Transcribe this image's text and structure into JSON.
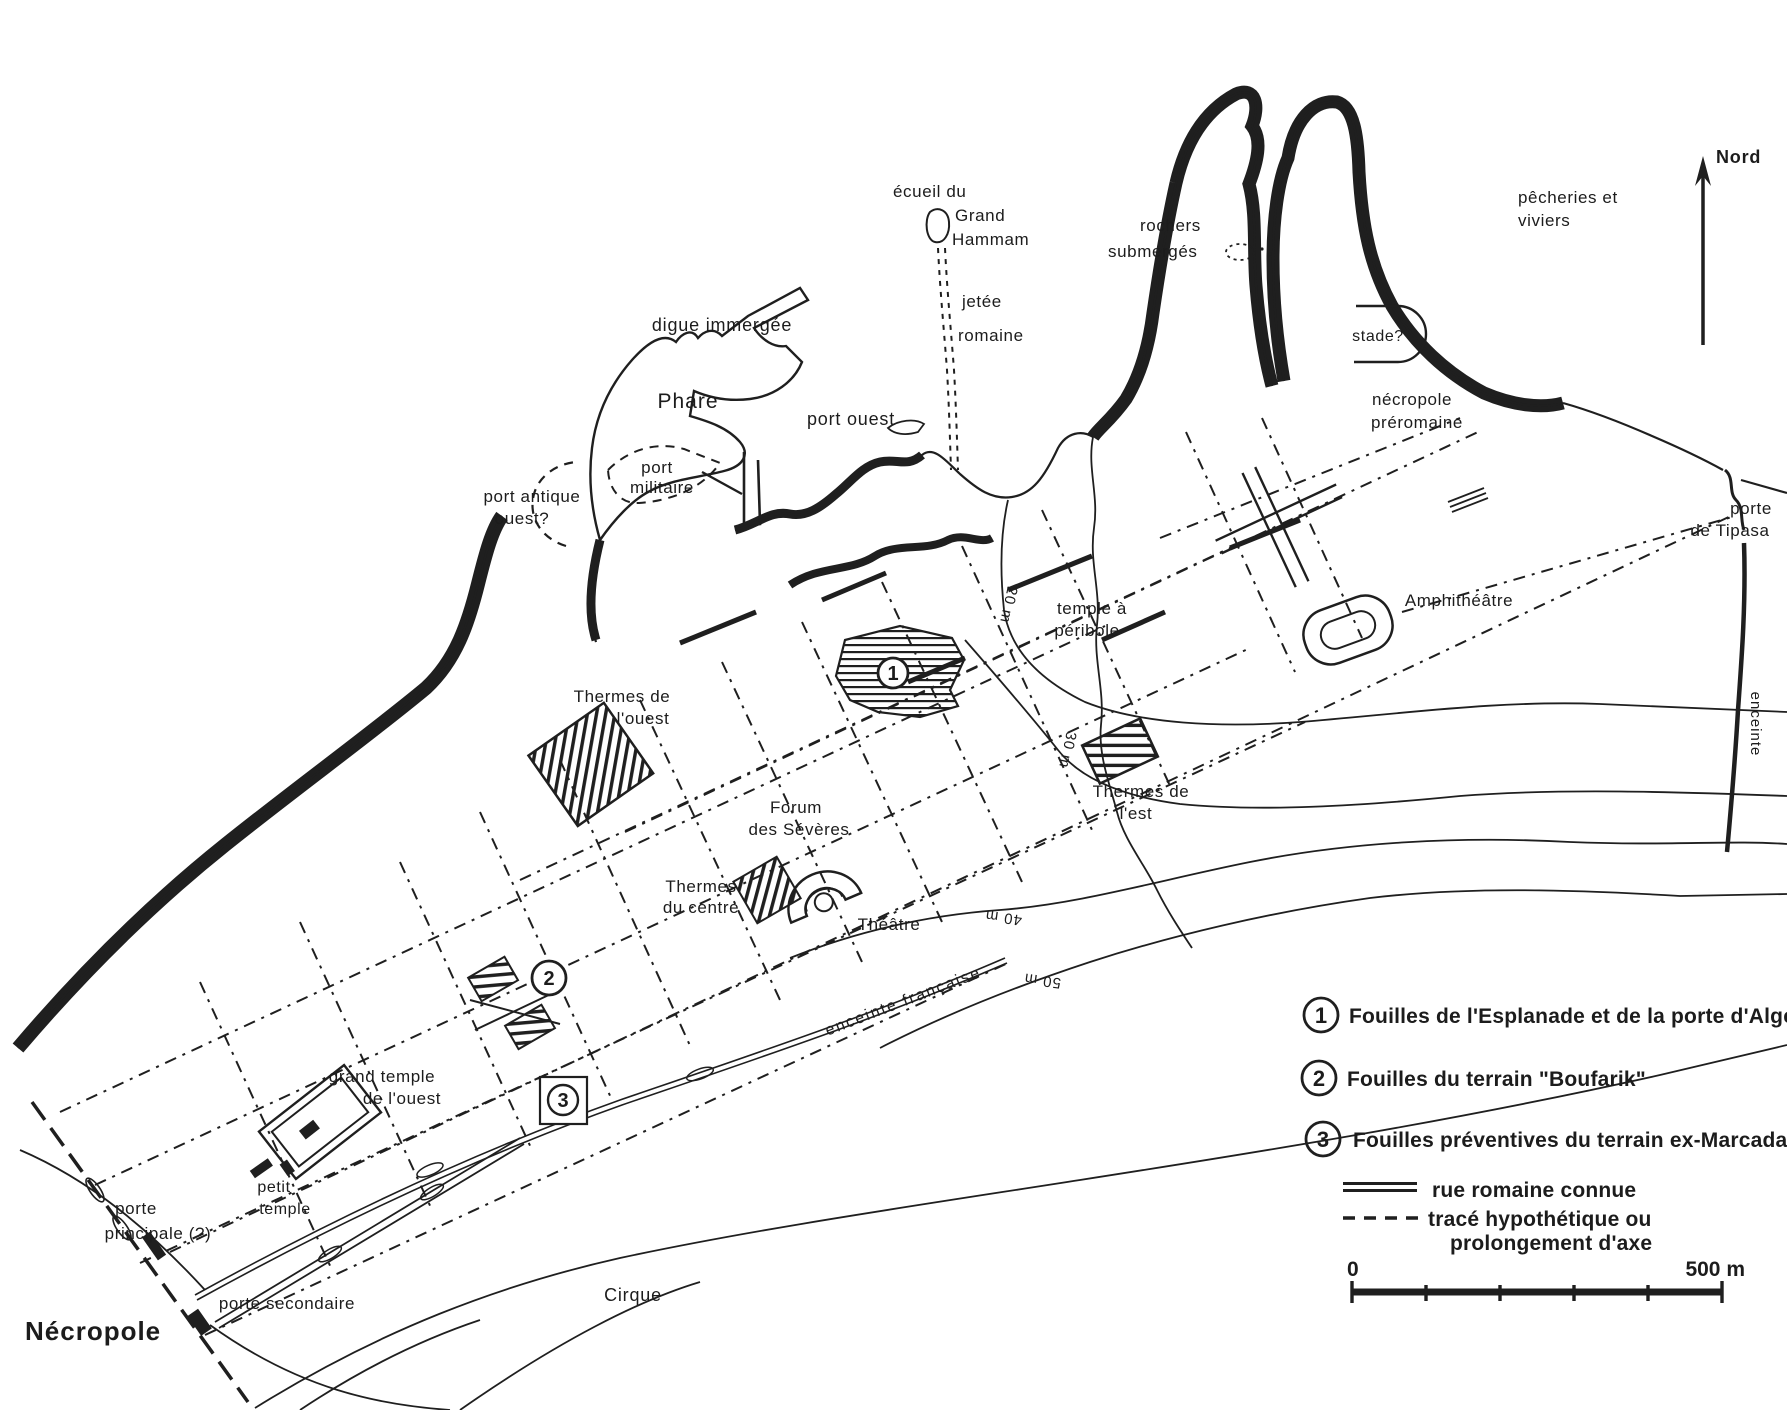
{
  "colors": {
    "ink": "#1f1f1f",
    "paper": "#ffffff"
  },
  "north": {
    "label": "Nord"
  },
  "map": {
    "labels": [
      {
        "text": "Nord"
      },
      {
        "text": "pêcheries et"
      },
      {
        "text": "viviers"
      },
      {
        "text": "écueil du"
      },
      {
        "text": "Grand"
      },
      {
        "text": "Hammam"
      },
      {
        "text": "jetée"
      },
      {
        "text": "romaine"
      },
      {
        "text": "rochers"
      },
      {
        "text": "submergés"
      },
      {
        "text": "digue immergée"
      },
      {
        "text": "Phare"
      },
      {
        "text": "port ouest"
      },
      {
        "text": "port"
      },
      {
        "text": "militaire"
      },
      {
        "text": "port antique"
      },
      {
        "text": "ouest?"
      },
      {
        "text": "stade?"
      },
      {
        "text": "nécropole"
      },
      {
        "text": "préromaine"
      },
      {
        "text": "porte"
      },
      {
        "text": "de Tipasa"
      },
      {
        "text": "Amphithéâtre"
      },
      {
        "text": "temple à"
      },
      {
        "text": "péribole"
      },
      {
        "text": "Thermes de"
      },
      {
        "text": "l'ouest"
      },
      {
        "text": "Forum"
      },
      {
        "text": "des Sévères"
      },
      {
        "text": "Thermes"
      },
      {
        "text": "du centre"
      },
      {
        "text": "Théâtre"
      },
      {
        "text": "Thermes de"
      },
      {
        "text": "l'est"
      },
      {
        "text": "grand temple"
      },
      {
        "text": "de l'ouest"
      },
      {
        "text": "petit"
      },
      {
        "text": "temple"
      },
      {
        "text": "porte"
      },
      {
        "text": "principale (?)"
      },
      {
        "text": "porte secondaire"
      },
      {
        "text": "Nécropole"
      },
      {
        "text": "Cirque"
      },
      {
        "text": "enceinte française"
      },
      {
        "text": "enceinte"
      },
      {
        "text": "20 m"
      },
      {
        "text": "30 m"
      },
      {
        "text": "40 m"
      },
      {
        "text": "50 m"
      }
    ],
    "markers": [
      {
        "num": "1"
      },
      {
        "num": "2"
      },
      {
        "num": "3"
      }
    ]
  },
  "legend": {
    "items": [
      {
        "num": "1",
        "text": "Fouilles de l'Esplanade et de la porte d'Alger"
      },
      {
        "num": "2",
        "text": "Fouilles du terrain \"Boufarik\""
      },
      {
        "num": "3",
        "text": "Fouilles préventives du terrain ex-Marcadal"
      }
    ],
    "lines": [
      {
        "symbol": "double-line",
        "text": "rue romaine connue"
      },
      {
        "symbol": "dashed-line",
        "text": "tracé hypothétique ou",
        "text2": "prolongement d'axe"
      }
    ],
    "scale": {
      "start": "0",
      "end": "500 m"
    }
  }
}
